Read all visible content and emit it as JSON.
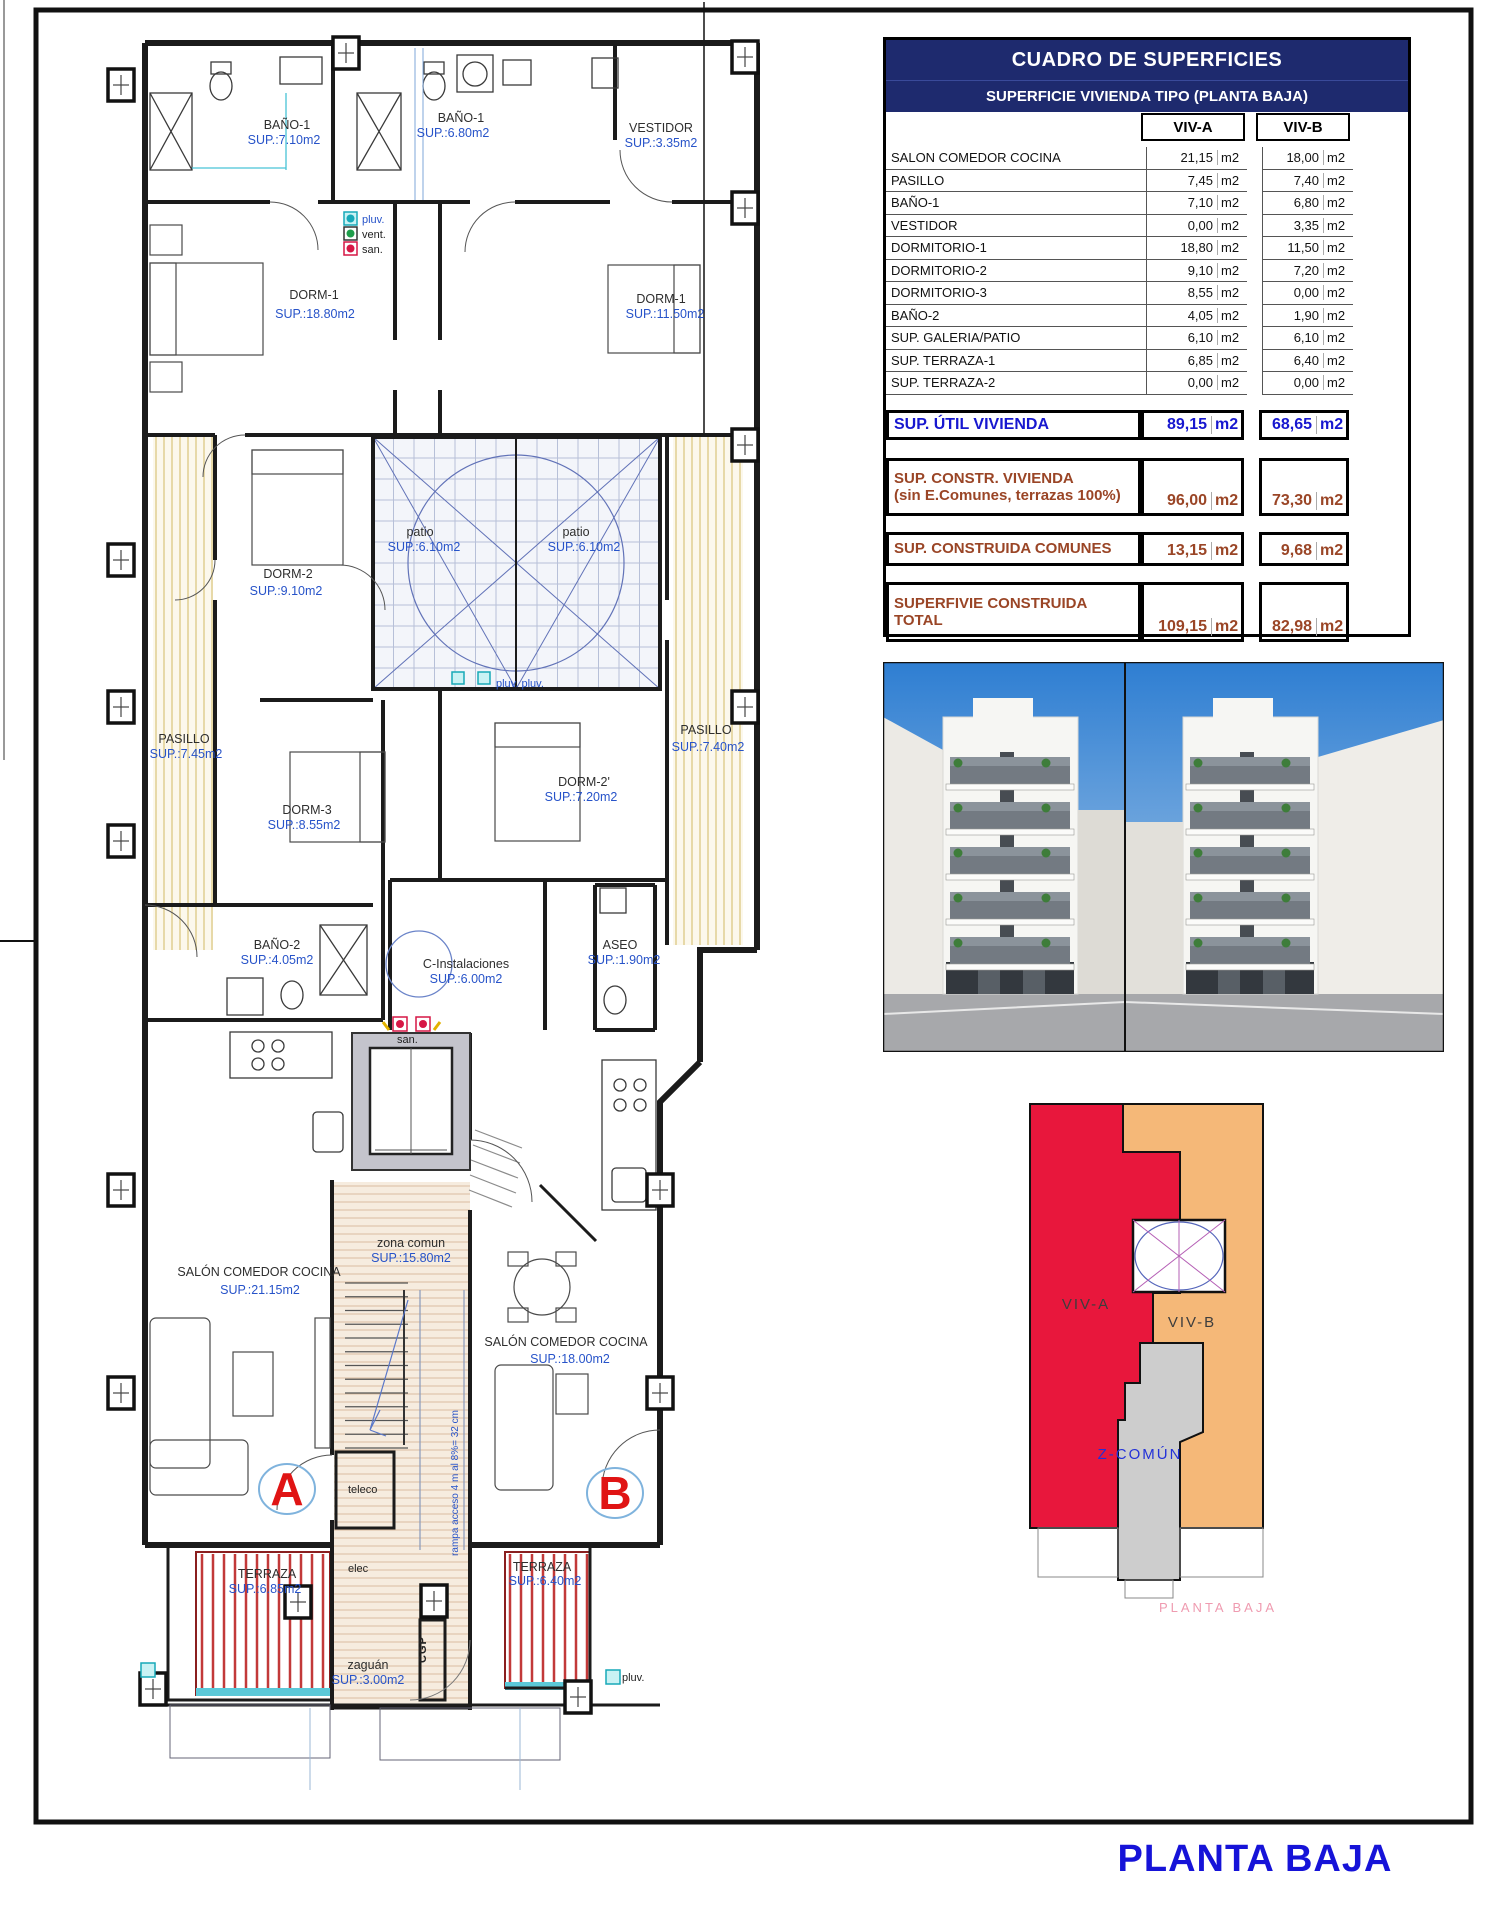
{
  "sheet": {
    "title": "PLANTA BAJA"
  },
  "table": {
    "title": "CUADRO DE SUPERFICIES",
    "subtitle": "SUPERFICIE VIVIENDA TIPO  (PLANTA BAJA)",
    "col_a": "VIV-A",
    "col_b": "VIV-B",
    "unit": "m2",
    "rows": [
      {
        "label": "SALON COMEDOR COCINA",
        "a": "21,15",
        "b": "18,00"
      },
      {
        "label": "PASILLO",
        "a": "7,45",
        "b": "7,40"
      },
      {
        "label": "BAÑO-1",
        "a": "7,10",
        "b": "6,80"
      },
      {
        "label": "VESTIDOR",
        "a": "0,00",
        "b": "3,35"
      },
      {
        "label": "DORMITORIO-1",
        "a": "18,80",
        "b": "11,50"
      },
      {
        "label": "DORMITORIO-2",
        "a": "9,10",
        "b": "7,20"
      },
      {
        "label": "DORMITORIO-3",
        "a": "8,55",
        "b": "0,00"
      },
      {
        "label": "BAÑO-2",
        "a": "4,05",
        "b": "1,90"
      },
      {
        "label": "SUP. GALERIA/PATIO",
        "a": "6,10",
        "b": "6,10"
      },
      {
        "label": "SUP. TERRAZA-1",
        "a": "6,85",
        "b": "6,40"
      },
      {
        "label": "SUP. TERRAZA-2",
        "a": "0,00",
        "b": "0,00"
      }
    ],
    "util": {
      "label": "SUP. ÚTIL VIVIENDA",
      "a": "89,15",
      "b": "68,65"
    },
    "constr": {
      "label1": "SUP. CONSTR. VIVIENDA",
      "label2": "(sin E.Comunes, terrazas 100%)",
      "a": "96,00",
      "b": "73,30"
    },
    "comunes": {
      "label": "SUP. CONSTRUIDA COMUNES",
      "a": "13,15",
      "b": "9,68"
    },
    "total": {
      "label1": "SUPERFIVIE CONSTRUIDA",
      "label2": "TOTAL",
      "a": "109,15",
      "b": "82,98"
    }
  },
  "plan": {
    "rooms": [
      {
        "name": "BAÑO-1",
        "sup": "SUP.:7.10m2",
        "nx": 287,
        "ny": 129,
        "sx": 284,
        "sy": 144
      },
      {
        "name": "BAÑO-1",
        "sup": "SUP.:6.80m2",
        "nx": 461,
        "ny": 122,
        "sx": 453,
        "sy": 137
      },
      {
        "name": "VESTIDOR",
        "sup": "SUP.:3.35m2",
        "nx": 661,
        "ny": 132,
        "sx": 661,
        "sy": 147
      },
      {
        "name": "DORM-1",
        "sup": "SUP.:18.80m2",
        "nx": 314,
        "ny": 299,
        "sx": 315,
        "sy": 318
      },
      {
        "name": "DORM-1",
        "sup": "SUP.:11.50m2",
        "nx": 661,
        "ny": 303,
        "sx": 665,
        "sy": 318
      },
      {
        "name": "DORM-2",
        "sup": "SUP.:9.10m2",
        "nx": 288,
        "ny": 578,
        "sx": 286,
        "sy": 595
      },
      {
        "name": "patio",
        "sup": "SUP.:6.10m2",
        "nx": 420,
        "ny": 536,
        "sx": 424,
        "sy": 551
      },
      {
        "name": "patio",
        "sup": "SUP.:6.10m2",
        "nx": 576,
        "ny": 536,
        "sx": 584,
        "sy": 551
      },
      {
        "name": "PASILLO",
        "sup": "SUP.:7.45m2",
        "nx": 184,
        "ny": 743,
        "sx": 186,
        "sy": 758
      },
      {
        "name": "PASILLO",
        "sup": "SUP.:7.40m2",
        "nx": 706,
        "ny": 734,
        "sx": 708,
        "sy": 751
      },
      {
        "name": "DORM-3",
        "sup": "SUP.:8.55m2",
        "nx": 307,
        "ny": 814,
        "sx": 304,
        "sy": 829
      },
      {
        "name": "DORM-2'",
        "sup": "SUP.:7.20m2",
        "nx": 584,
        "ny": 786,
        "sx": 581,
        "sy": 801
      },
      {
        "name": "BAÑO-2",
        "sup": "SUP.:4.05m2",
        "nx": 277,
        "ny": 949,
        "sx": 277,
        "sy": 964
      },
      {
        "name": "C-Instalaciones",
        "sup": "SUP.:6.00m2",
        "nx": 466,
        "ny": 968,
        "sx": 466,
        "sy": 983
      },
      {
        "name": "ASEO",
        "sup": "SUP.:1.90m2",
        "nx": 620,
        "ny": 949,
        "sx": 624,
        "sy": 964
      },
      {
        "name": "SALÓN COMEDOR COCINA",
        "sup": "SUP.:21.15m2",
        "nx": 259,
        "ny": 1276,
        "sx": 260,
        "sy": 1294
      },
      {
        "name": "zona comun",
        "sup": "SUP.:15.80m2",
        "nx": 411,
        "ny": 1247,
        "sx": 411,
        "sy": 1262
      },
      {
        "name": "SALÓN COMEDOR COCINA",
        "sup": "SUP.:18.00m2",
        "nx": 566,
        "ny": 1346,
        "sx": 570,
        "sy": 1363
      },
      {
        "name": "TERRAZA",
        "sup": "SUP.:6.85m2",
        "nx": 267,
        "ny": 1578,
        "sx": 265,
        "sy": 1593
      },
      {
        "name": "TERRAZA",
        "sup": "SUP.:6.40m2",
        "nx": 542,
        "ny": 1571,
        "sx": 545,
        "sy": 1585
      },
      {
        "name": "zaguán",
        "sup": "SUP.:3.00m2",
        "nx": 368,
        "ny": 1669,
        "sx": 368,
        "sy": 1684
      }
    ],
    "legend": {
      "pluv": "pluv.",
      "vent": "vent.",
      "san": "san."
    },
    "marks": {
      "patio_pluv": "pluv. pluv.",
      "san": "san.",
      "teleco": "teleco",
      "elec": "elec",
      "cgp": "CGP",
      "pluv_right": "pluv.",
      "ramp": "rampa acceso 4 m al 8%= 32 cm",
      "unit_a": "A",
      "unit_b": "B"
    }
  },
  "diagram": {
    "viv_a": "VIV-A",
    "viv_b": "VIV-B",
    "z_comun": "Z-COMÚN",
    "caption": "PLANTA BAJA",
    "colors": {
      "viv_a": "#e8173c",
      "viv_b": "#f5b878",
      "z_comun": "#cdcdcd"
    }
  }
}
